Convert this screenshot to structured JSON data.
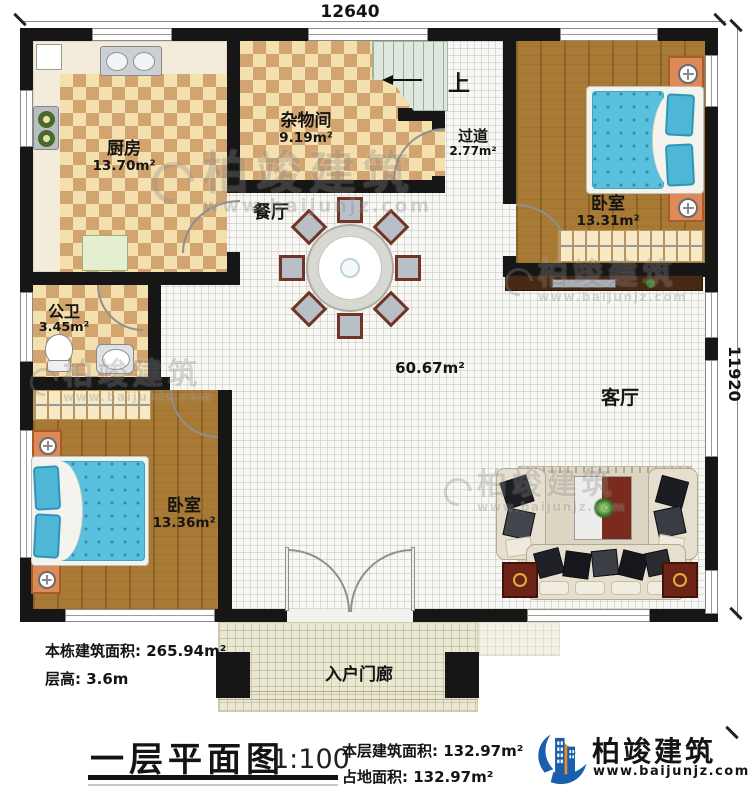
{
  "dims": {
    "top": "12640",
    "right": "11920"
  },
  "rooms": {
    "kitchen": {
      "name": "厨房",
      "area": "13.70m²"
    },
    "storage": {
      "name": "杂物间",
      "area": "9.19m²"
    },
    "hallway": {
      "name": "过道",
      "area": "2.77m²"
    },
    "bedroom_tr": {
      "name": "卧室",
      "area": "13.31m²"
    },
    "bathroom": {
      "name": "公卫",
      "area": "3.45m²"
    },
    "bedroom_bl": {
      "name": "卧室",
      "area": "13.36m²"
    },
    "dining": {
      "name": "餐厅"
    },
    "living": {
      "name": "客厅"
    },
    "porch": {
      "name": "入户门廊"
    },
    "open_area": "60.67m²"
  },
  "stairs": {
    "up_label": "上"
  },
  "info_left": {
    "building_area_label": "本栋建筑面积:",
    "building_area_value": "265.94m²",
    "floor_height_label": "层高:",
    "floor_height_value": "3.6m"
  },
  "title_block": {
    "title": "一层平面图",
    "scale": "1:100",
    "floor_area_label": "本层建筑面积:",
    "floor_area_value": "132.97m²",
    "footprint_label": "占地面积:",
    "footprint_value": "132.97m²"
  },
  "brand": {
    "name": "柏竣建筑",
    "website": "www.baijunjz.com"
  },
  "watermark": {
    "name": "柏竣建筑",
    "website": "www.baijunjz.com"
  },
  "colors": {
    "wall": "#161616",
    "checker_light": "#f4dfae",
    "checker_dark": "#d2a470",
    "wood": "#a87a35",
    "bed_blue": "#59c1de",
    "brand_blue": "#1a5fae",
    "brand_orange": "#f08c1e"
  }
}
